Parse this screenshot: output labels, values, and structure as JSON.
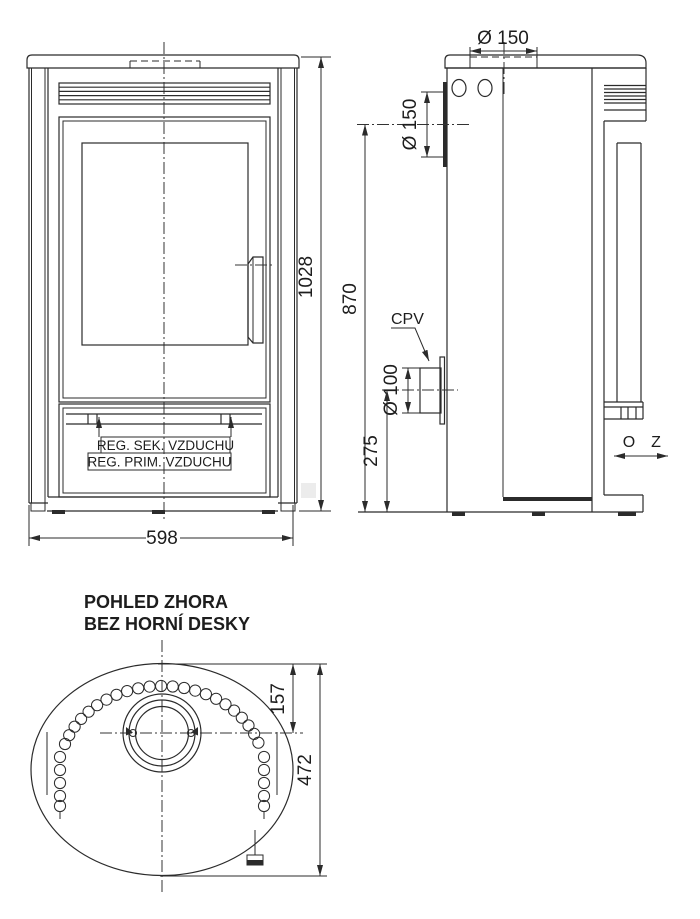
{
  "front_view": {
    "dim_height": "1028",
    "dim_width": "598",
    "label_reg_sek": "REG. SEK. VZDUCHU",
    "label_reg_prim": "REG. PRIM. VZDUCHU"
  },
  "side_view": {
    "dim_top_flue": "Ø 150",
    "dim_rear_flue": "Ø 150",
    "dim_rear_flue_height": "870",
    "dim_cpv_diameter": "Ø 100",
    "dim_cpv_height": "275",
    "label_cpv": "CPV",
    "label_open": "O",
    "label_closed": "Z"
  },
  "top_view": {
    "title_line1": "POHLED ZHORA",
    "title_line2": "BEZ HORNÍ DESKY",
    "dim_flue_offset": "157",
    "dim_depth": "472"
  }
}
